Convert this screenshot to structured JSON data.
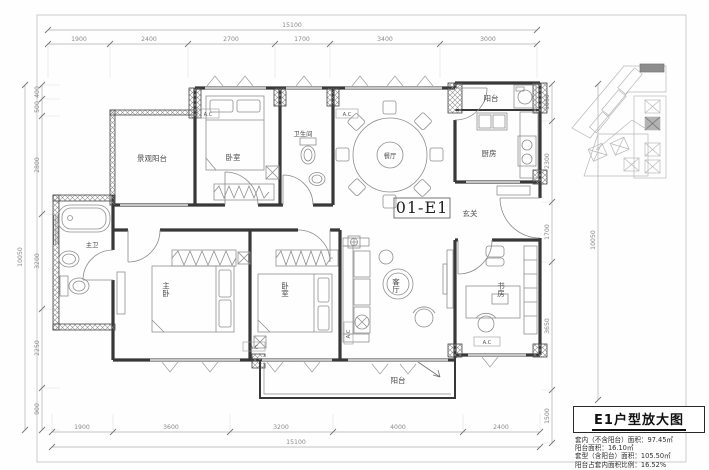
{
  "sheet": {
    "unit_label": "01-E1"
  },
  "rooms": {
    "view_balcony": "景观阳台",
    "bedroom_top": "卧室",
    "bathroom": "卫生间",
    "dining": "餐厅",
    "balcony_top": "阳台",
    "kitchen": "厨房",
    "foyer": "玄关",
    "living_room": "客厅",
    "study": "书房",
    "master_bedroom": "主卧",
    "bedroom_2": "卧室",
    "master_bath": "主卫",
    "balcony_bottom": "阳台",
    "ac_tag": "A.C"
  },
  "dimensions": {
    "top": {
      "total": "15100",
      "segments": [
        "1900",
        "2400",
        "2700",
        "1700",
        "3400",
        "3000"
      ]
    },
    "bottom": {
      "total": "15100",
      "segments": [
        "1900",
        "3600",
        "3200",
        "4000",
        "2400"
      ]
    },
    "left": {
      "total": "10050",
      "segments": [
        "400",
        "500",
        "2800",
        "3200",
        "2250",
        "900"
      ]
    },
    "right": {
      "total": "10050",
      "segments": [
        "1050",
        "2300",
        "1700",
        "3650",
        "1500"
      ]
    }
  },
  "title_block": {
    "title": "E1户型放大图",
    "info_lines": [
      "套内（不含阳台）面积：97.45㎡",
      "阳台面积：16.10㎡",
      "套型（含阳台）面积：105.50㎡",
      "阳台占套内面积比例：16.52%"
    ]
  }
}
